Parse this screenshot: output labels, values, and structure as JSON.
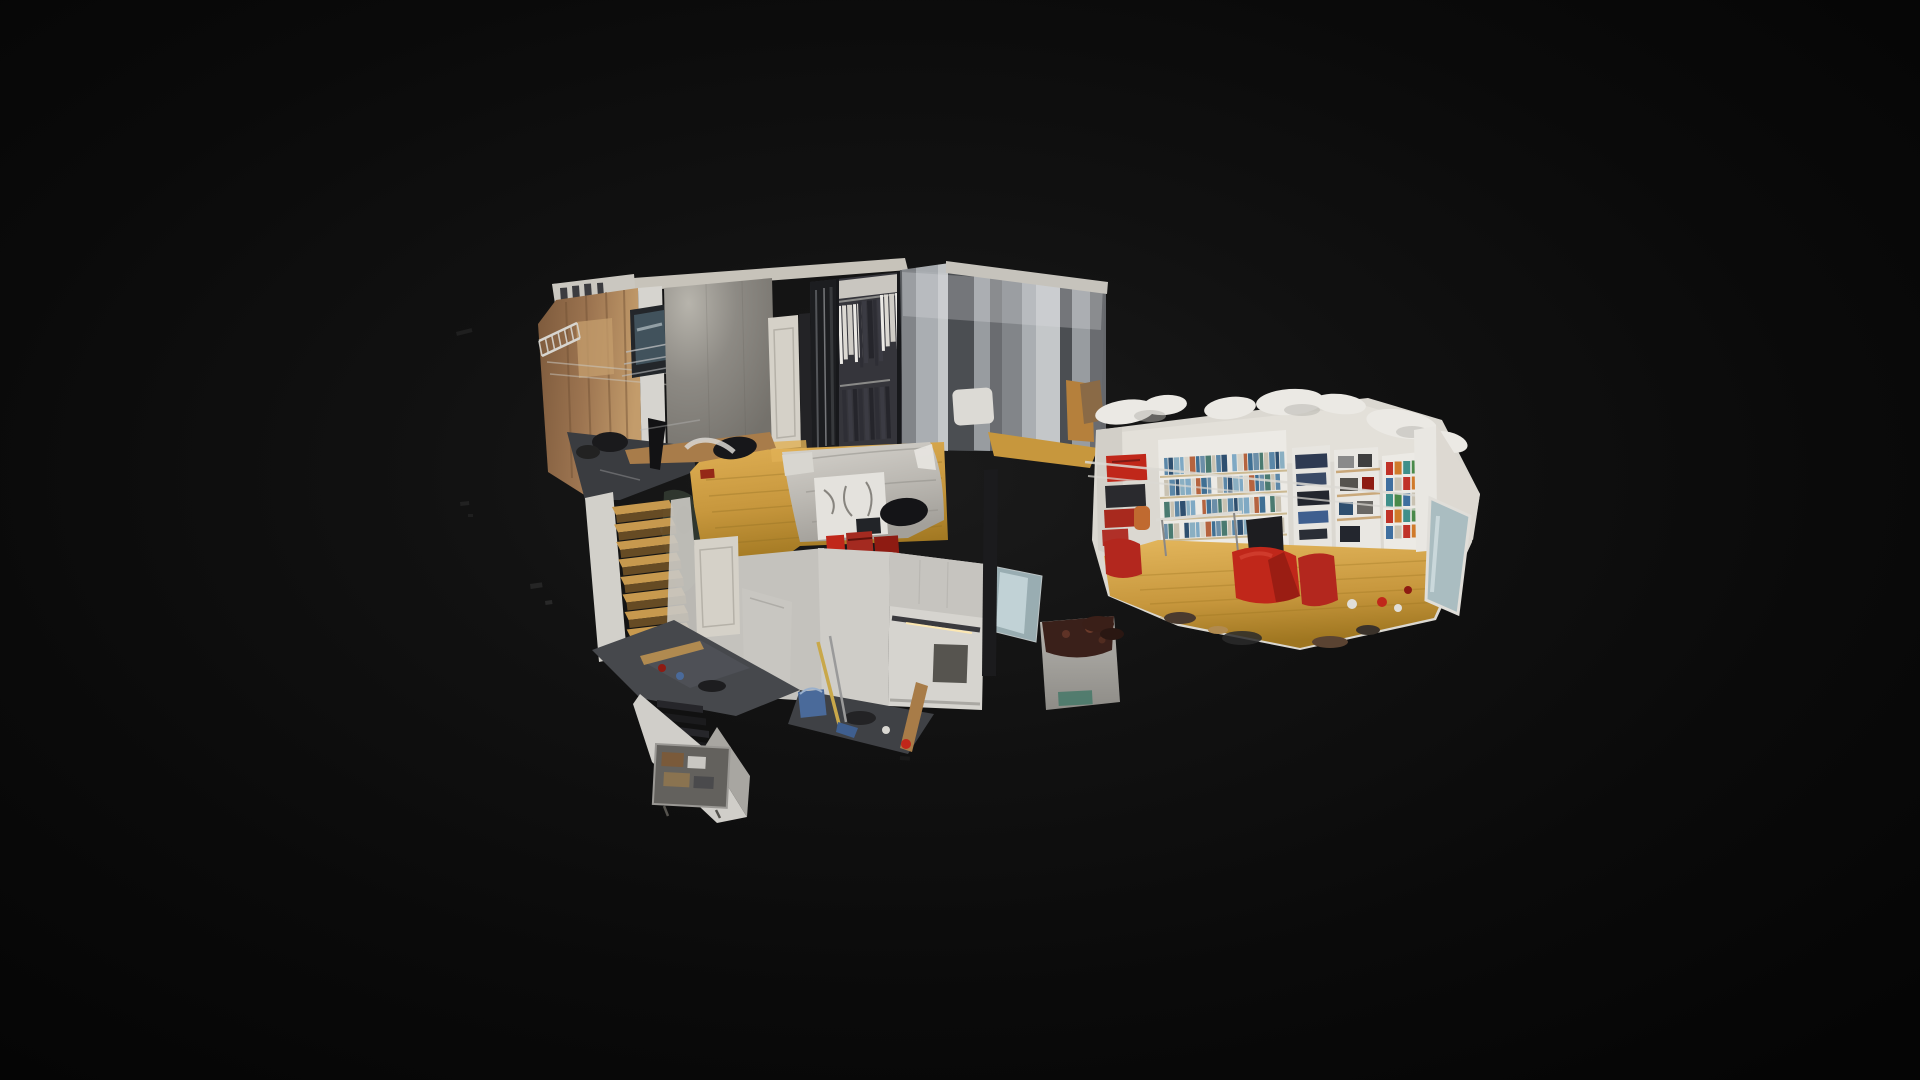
{
  "scene": {
    "type": "dollhouse-3d-view",
    "description": "Cutaway 3D scan model of a split-level apartment floating on a dark vignette backdrop",
    "background": {
      "glow": "#1b1b1b",
      "mid": "#111111",
      "base": "#0a0a0a",
      "corner": "#050505"
    }
  },
  "palette": {
    "plywood_dark": "#7d5a3c",
    "plywood": "#9c7450",
    "plywood_light": "#c39c6b",
    "concrete_wall": "#8d8a84",
    "wall_bloom": "#b7b4ac",
    "wall_dark": "#74716b",
    "ceiling_rim": "#c7c3ba",
    "white_wall": "#d6d4cf",
    "white_wall_shade": "#aeaca7",
    "door": "#d5d1c8",
    "wood_floor": "#c7973d",
    "wood_floor_bright": "#e0b055",
    "wood_floor_dark": "#9f7620",
    "slate_floor": "#46484c",
    "landing": "#3a3c40",
    "bed_quilt": "#bcb9b3",
    "bed_highlight": "#d6d3cd",
    "bed_shadow": "#a3a09a",
    "bed_fold": "#8e8b85",
    "wardrobe": "#1c1d20",
    "wardrobe_back": "#35353b",
    "cloth_whites": [
      "#eceae6",
      "#dcd9d3",
      "#cfccc6"
    ],
    "cloth_darks": [
      "#2e2e35",
      "#3b3b43",
      "#25252b"
    ],
    "mirror_glass": "#aabdc1",
    "teal_glass": "#bad3d9",
    "stair_tread": "#c7994e",
    "stair_riser": "#6e5026",
    "red": "#c0271a",
    "red_dark": "#8e1b12",
    "orange": "#d07a2a",
    "book_colors": [
      "#5b87a8",
      "#7fa9c4",
      "#3f6f93",
      "#c9c2b2",
      "#8aafc2",
      "#b5643f",
      "#4a7a70",
      "#2e4f6f",
      "#d9d5c9",
      "#6b8ea8"
    ],
    "can_colors": [
      "#c03228",
      "#d07a2a",
      "#3f8f8a",
      "#4a8a4a",
      "#3f6f9f",
      "#c9c2b2"
    ],
    "panel_colors": [
      "#84878b",
      "#aeb2b6",
      "#c9cccf",
      "#4a4d51",
      "#9b9fa3",
      "#6a6d71"
    ],
    "shelf_frame": "#eceae5",
    "shelf_wood": "#c9a87a",
    "kitchen_counter": "#3a3a3e",
    "cabinet_light": "#ffe9b0",
    "bin_metal": "#b5b3ae",
    "bin_contents": "#3a201a",
    "bucket_blue": "#4a6a9a",
    "mop_yellow": "#c9a84a",
    "green_mass": "#2f362e"
  }
}
